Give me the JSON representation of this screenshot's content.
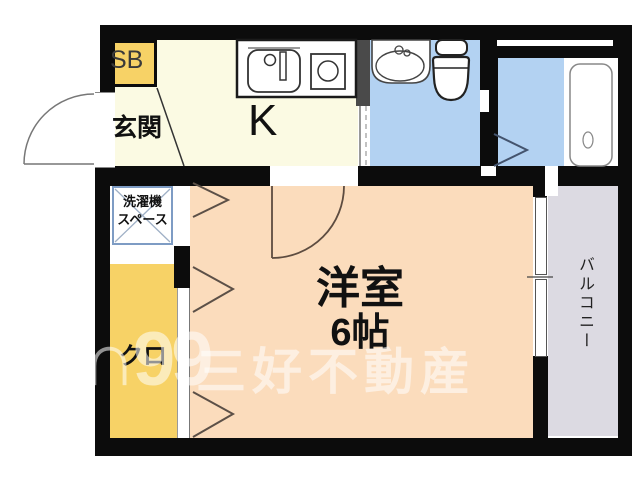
{
  "floorplan": {
    "labels": {
      "storage_box": "SB",
      "entrance": "玄関",
      "kitchen": "K",
      "washer_line1": "洗濯機",
      "washer_line2": "スペース",
      "closet": "クロ",
      "main_room_name": "洋室",
      "main_room_size": "6帖",
      "balcony": "バルコニー"
    },
    "watermark": {
      "logo": "∩99",
      "company": "三好不動産"
    },
    "colors": {
      "wall": "#0c0c0c",
      "wall_gray": "#4a4a4a",
      "kitchen_floor": "#fbfae3",
      "storage_yellow": "#f7d266",
      "bath_blue": "#b3d2f2",
      "room_peach": "#fbdcbc",
      "balcony_gray": "#dcdae2",
      "washer_border": "#7e9cc4"
    }
  }
}
